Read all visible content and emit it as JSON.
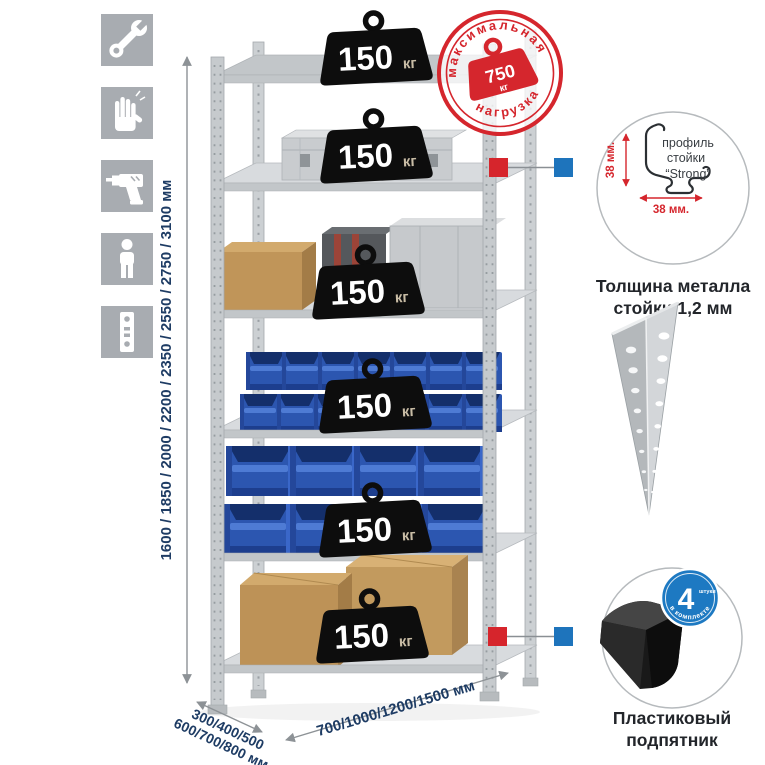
{
  "canvas": {
    "width": 765,
    "height": 765,
    "background": "#ffffff"
  },
  "assembly_icons": [
    {
      "name": "wrench"
    },
    {
      "name": "gloves"
    },
    {
      "name": "drill"
    },
    {
      "name": "person"
    },
    {
      "name": "perforated-post"
    }
  ],
  "dimensions": {
    "height_options": "1600 / 1850 / 2000 / 2200 / 2350 / 2550 / 2750 / 3100 мм",
    "depth_options_line1": "300/400/500",
    "depth_options_line2": "600/700/800 мм",
    "width_options": "700/1000/1200/1500 мм"
  },
  "shelves": [
    {
      "load": "150",
      "unit": "кг"
    },
    {
      "load": "150",
      "unit": "кг"
    },
    {
      "load": "150",
      "unit": "кг"
    },
    {
      "load": "150",
      "unit": "кг"
    },
    {
      "load": "150",
      "unit": "кг"
    },
    {
      "load": "150",
      "unit": "кг"
    }
  ],
  "max_load_stamp": {
    "arc_top": "максимальная",
    "arc_bottom": "нагрузка",
    "value": "750",
    "unit": "кг"
  },
  "post_profile_detail": {
    "label_line1": "профиль",
    "label_line2": "стойки",
    "label_line3": "“Strong”",
    "vertical_dim": "38 мм.",
    "horizontal_dim": "38 мм.",
    "caption_line1": "Толщина металла",
    "caption_line2": "стойки 1,2 мм"
  },
  "plastic_foot_detail": {
    "badge_value": "4",
    "badge_unit": "штуки",
    "badge_arc": "в комплекте",
    "caption_line1": "Пластиковый",
    "caption_line2": "подпятник"
  },
  "colors": {
    "stamp_red": "#d5262d",
    "callout_red": "#d6252c",
    "callout_blue": "#1e74bc",
    "bin_blue": "#2c56b0",
    "dimension_navy": "#1e3c64",
    "icon_gray": "#a8acb1"
  }
}
